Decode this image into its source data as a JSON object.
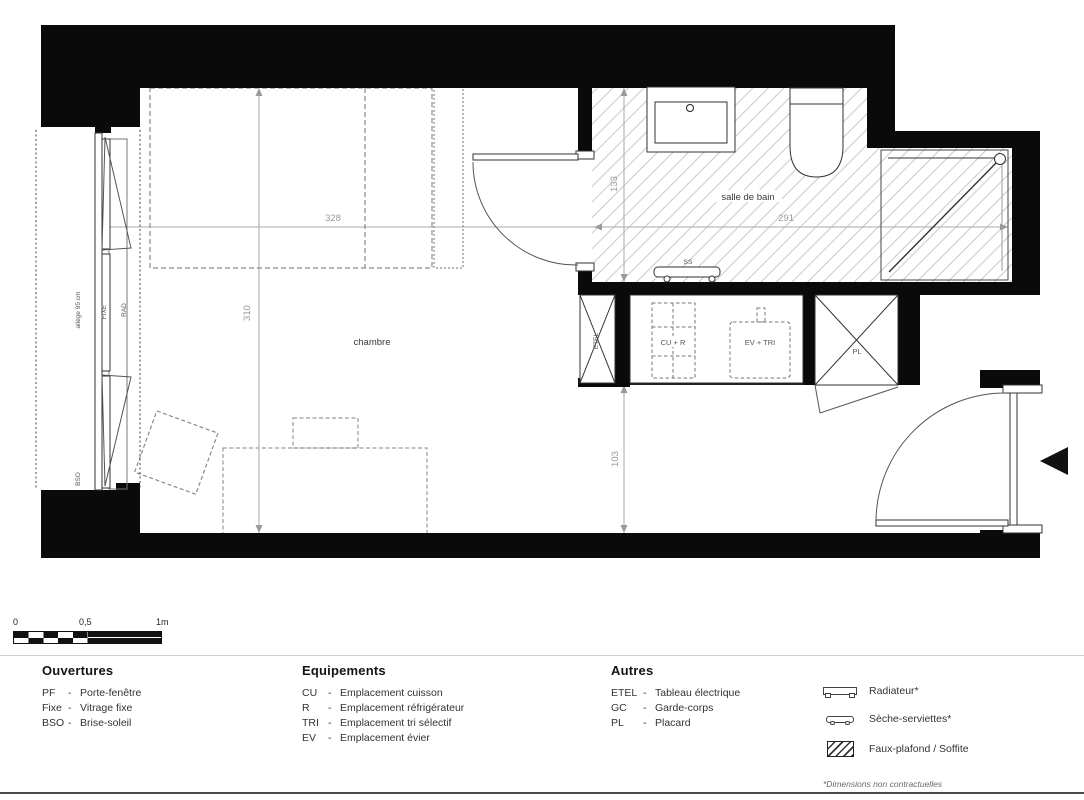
{
  "colors": {
    "wall": "#0a0a0a",
    "hatch_line": "#c9c9c9",
    "dim_line": "#9a9a9a",
    "drawing_line": "#333333"
  },
  "plan": {
    "rooms": {
      "bedroom": "chambre",
      "bathroom": "salle de bain"
    },
    "dims": {
      "bedroom_width": "328",
      "bedroom_height": "310",
      "bathroom_height": "133",
      "bathroom_width": "291",
      "hall_height": "103"
    },
    "window": {
      "allege": "allège 95 cm",
      "fixe": "FIXE",
      "rad": "RAD",
      "bso": "BSO"
    },
    "equipment": {
      "etel": "ETEL",
      "cu_r": "CU + R",
      "ev_tri": "EV + TRI",
      "pl": "PL",
      "ss": "SS"
    }
  },
  "scalebar": {
    "zero": "0",
    "half": "0,5",
    "one": "1m"
  },
  "legend": {
    "sep": "-",
    "ouvertures": {
      "title": "Ouvertures",
      "items": [
        {
          "abbr": "PF",
          "label": "Porte-fenêtre"
        },
        {
          "abbr": "Fixe",
          "label": "Vitrage fixe"
        },
        {
          "abbr": "BSO",
          "label": "Brise-soleil"
        }
      ]
    },
    "equipements": {
      "title": "Equipements",
      "items": [
        {
          "abbr": "CU",
          "label": "Emplacement cuisson"
        },
        {
          "abbr": "R",
          "label": "Emplacement réfrigérateur"
        },
        {
          "abbr": "TRI",
          "label": "Emplacement tri sélectif"
        },
        {
          "abbr": "EV",
          "label": "Emplacement évier"
        }
      ]
    },
    "autres": {
      "title": "Autres",
      "items": [
        {
          "abbr": "ETEL",
          "label": "Tableau électrique"
        },
        {
          "abbr": "GC",
          "label": "Garde-corps"
        },
        {
          "abbr": "PL",
          "label": "Placard"
        }
      ]
    },
    "symbols": [
      {
        "name": "radiator",
        "label": "Radiateur*"
      },
      {
        "name": "towel-dryer",
        "label": "Sèche-serviettes*"
      },
      {
        "name": "soffit-hatch",
        "label": "Faux-plafond / Soffite"
      }
    ],
    "footnote": "*Dimensions non contractuelles"
  }
}
